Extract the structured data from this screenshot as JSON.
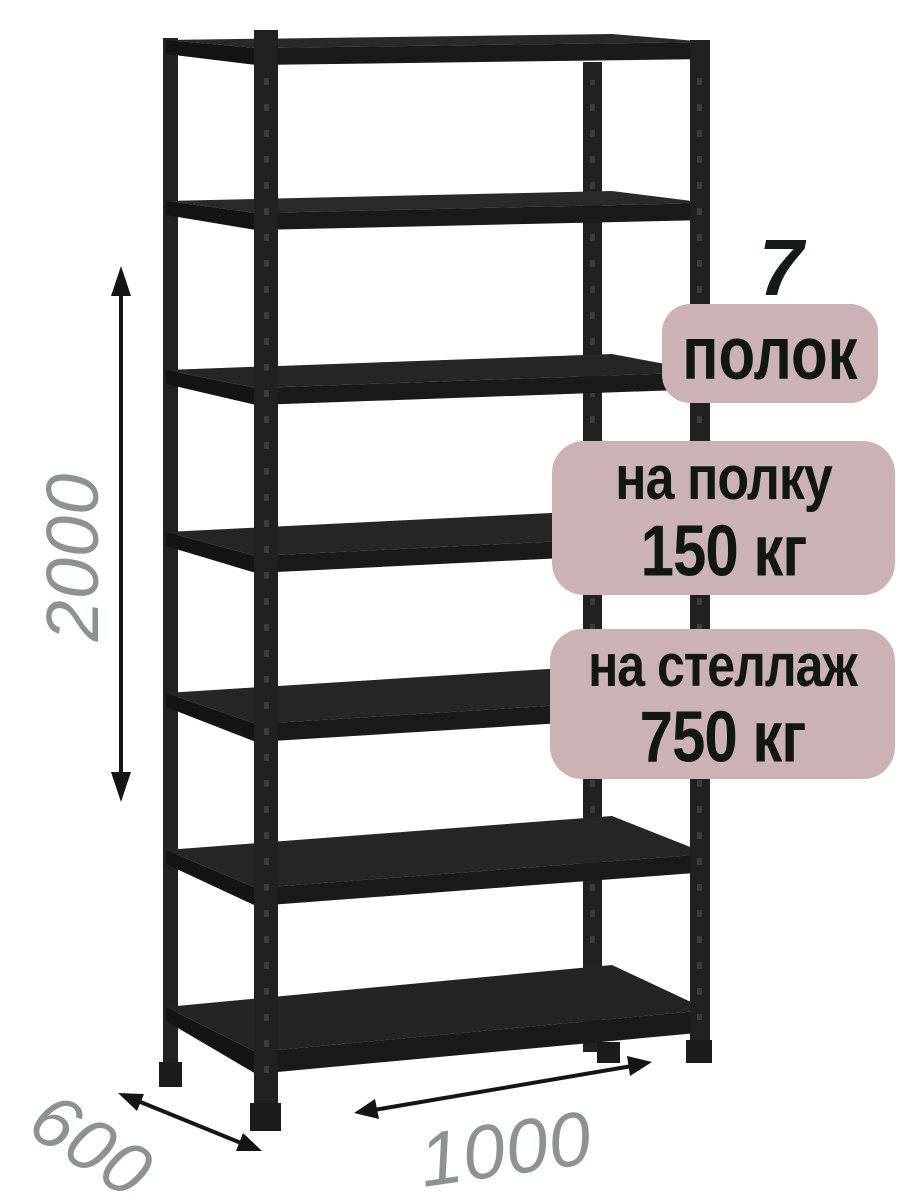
{
  "badges": {
    "shelf_count_number": "7",
    "shelf_count_label": "полок",
    "per_shelf_line1": "на полку",
    "per_shelf_line2": "150 кг",
    "per_rack_line1": "на стеллаж",
    "per_rack_line2": "750 кг"
  },
  "dimensions": {
    "height": "2000",
    "depth": "600",
    "width": "1000"
  },
  "rack": {
    "shelf_count": 7,
    "type": "metal-shelving-rack"
  },
  "colors": {
    "badge_background": "#ccb2b4",
    "badge_text": "#11180f",
    "dimension_text": "#8d9292",
    "rack_metal": "#1e1e1e",
    "background": "#ffffff"
  }
}
